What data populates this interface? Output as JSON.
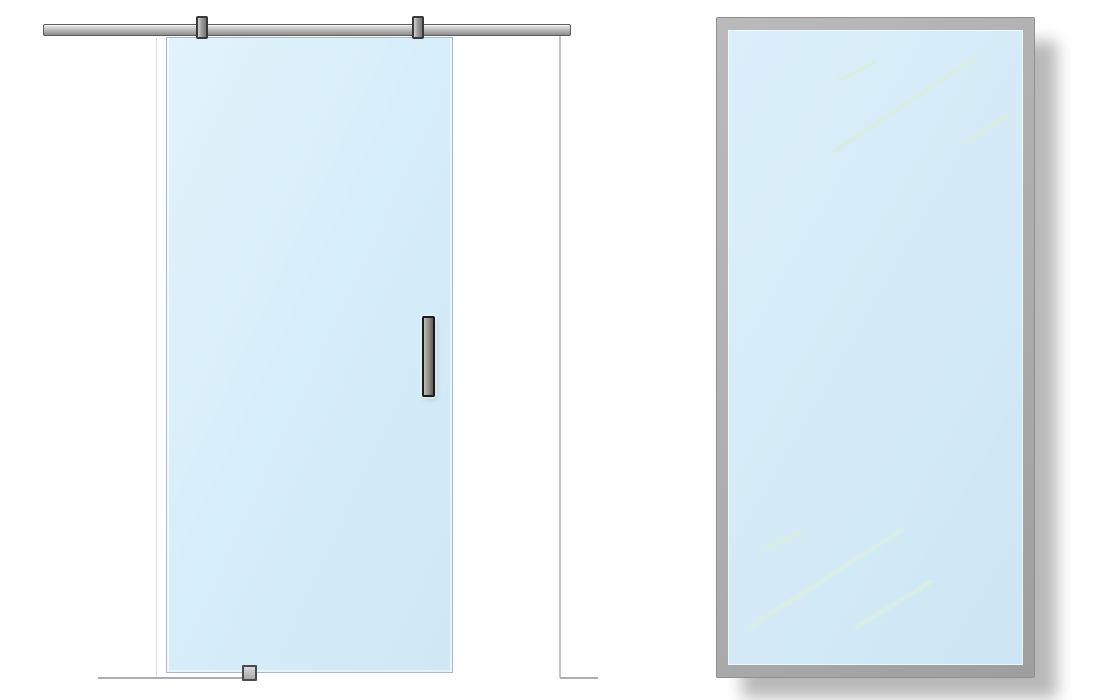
{
  "colors": {
    "background": "#ffffff",
    "glass-fill": "#d7eefa",
    "glass-fill-2": "#cfe8f4",
    "glass-border": "#a6bac4",
    "rail-mid": "#b5b5b5",
    "rail-dark": "#8d8d8d",
    "rail-border": "#5c5c5c",
    "bracket-border": "#383838",
    "handle-border": "#1a1a1a",
    "guide-border": "#4a4a4a",
    "frame-fill": "#adadad",
    "frame-edge": "#8f8f8f",
    "pane-fill": "#d3eaf6",
    "streak": "#daeee6",
    "floor-line": "#adadad",
    "jamb-line": "#c6c6c6",
    "jamb-line-faint": "#dedede",
    "shadow": "rgba(0,0,0,0.28)"
  },
  "reflection_streaks": {
    "viewbox": "0 0 295 635",
    "stroke_width": 4.5,
    "opacity": 0.9,
    "lines": [
      {
        "x1": 112,
        "y1": 50,
        "x2": 147,
        "y2": 32
      },
      {
        "x1": 105,
        "y1": 122,
        "x2": 247,
        "y2": 28
      },
      {
        "x1": 235,
        "y1": 113,
        "x2": 280,
        "y2": 86
      },
      {
        "x1": 38,
        "y1": 518,
        "x2": 72,
        "y2": 502
      },
      {
        "x1": 22,
        "y1": 597,
        "x2": 175,
        "y2": 499
      },
      {
        "x1": 129,
        "y1": 597,
        "x2": 202,
        "y2": 552
      }
    ]
  }
}
